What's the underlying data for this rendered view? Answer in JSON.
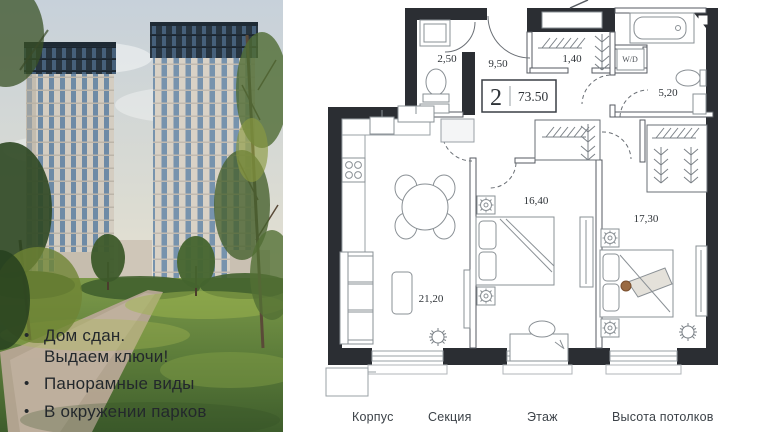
{
  "photo": {
    "bullet_icon": "•",
    "features": [
      {
        "line1": "Дом сдан.",
        "line2": "Выдаем ключи!"
      },
      {
        "line1": "Панорамные виды",
        "line2": ""
      },
      {
        "line1": "В окружении парков",
        "line2": ""
      }
    ]
  },
  "plan": {
    "summary": {
      "rooms": "2",
      "area": "73.50"
    },
    "rooms": {
      "wc": "2,50",
      "hallway": "9,50",
      "closet": "1,40",
      "washer": "W/D",
      "bathroom": "5,20",
      "bedroom1": "16,40",
      "bedroom2": "17,30",
      "living": "21,20"
    }
  },
  "footer": {
    "col1": "Корпус",
    "col2": "Секция",
    "col3": "Этаж",
    "col4": "Высота потолков"
  },
  "colors": {
    "wall": "#2b2e33",
    "plan_text": "#2e3338"
  }
}
